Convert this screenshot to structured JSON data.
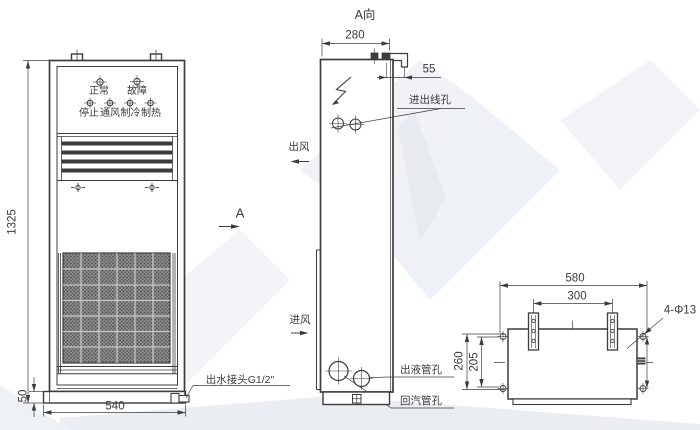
{
  "drawing": {
    "front_view": {
      "dim_height": "1325",
      "dim_base_height": "50",
      "dim_width": "540",
      "indicator_row1": [
        {
          "label": "正常"
        },
        {
          "label": "故障"
        }
      ],
      "indicator_row2": [
        {
          "label": "停止"
        },
        {
          "label": "通风"
        },
        {
          "label": "制冷"
        },
        {
          "label": "制热"
        }
      ],
      "water_outlet_label": "出水接头G1/2\"",
      "section_arrow_label": "A"
    },
    "side_view": {
      "view_title": "A向",
      "dim_depth": "280",
      "dim_bracket_offset": "55",
      "air_outlet_label": "出风",
      "air_inlet_label": "进风",
      "wire_holes_label": "进出线孔",
      "liquid_pipe_label": "出液管孔",
      "vapor_pipe_label": "回汽管孔"
    },
    "top_view": {
      "dim_width": "580",
      "dim_bracket_spacing": "300",
      "dim_depth": "260",
      "dim_hole_spacing": "205",
      "mounting_holes_label": "4-Φ13"
    },
    "colors": {
      "line": "#3c3c3c",
      "mesh_fill": "#8f8f8f",
      "watermark": "#edf0f4"
    }
  }
}
